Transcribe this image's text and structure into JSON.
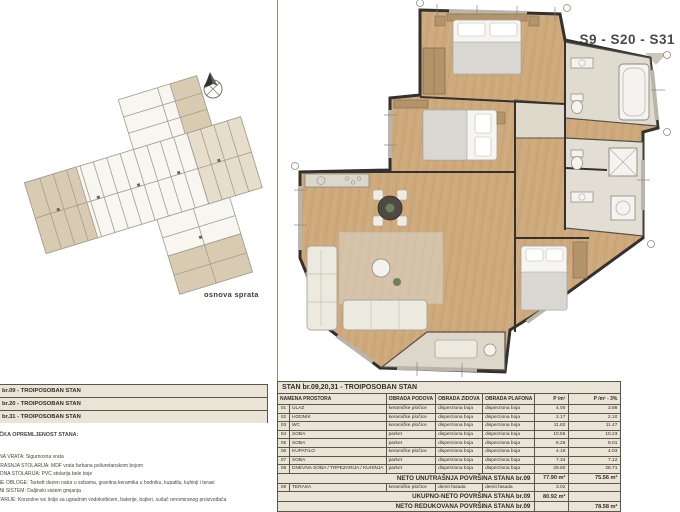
{
  "colors": {
    "paper": "#ffffff",
    "table_bg": "#eae4d6",
    "line_dark": "#5a564e",
    "wood_floor": "#cda97c",
    "tile_floor": "#e0dbcf",
    "site_beige": "#d8cbb2",
    "wall": "#33312d",
    "pointer_gray": "#ccc6b9",
    "accent_text": "#4a4a4a"
  },
  "left_panel": {
    "plan_caption": "osnova sprata",
    "apartment_list": [
      {
        "label": "AN br.09 - TROIPOSOBAN STAN"
      },
      {
        "label": "AN br.20 - TROIPOSOBAN STAN"
      },
      {
        "label": "AN br.31 - TROIPOSOBAN STAN"
      }
    ],
    "specs_heading": "HNIČKA OPREMLJENOST STANA:",
    "specs_lines": [
      "LAZNA VRATA: Sigurnosna vrata",
      "NUTRAŠNJA STOLARIJA: MDF vrata farbana poliuretanskom bojom",
      "ASADNA STOLARIJA: PVC stolarija bele boje",
      "ODNE OBLOGE: Tarkett dezen natur u sobama, granitna keramika u hodniku, kupatilu, kuhinji i terasi",
      "REJNI SISTEM: Daljinski sistem grejanja",
      "ANITARIJE: Konzolne wc šolje sa ugradnim vodokotlićem, baterije, bojleri, sušač renomiranog proizvođača"
    ]
  },
  "right_panel": {
    "units_label": "S9 - S20 - S31"
  },
  "table": {
    "title": "STAN br.09,20,31 - TROIPOSOBAN STAN",
    "headers": {
      "name": "NAMENA PROSTORA",
      "floor": "OBRADA PODOVA",
      "walls": "OBRADA ZIDOVA",
      "ceiling": "OBRADA PLAFONA",
      "area": "P /m²",
      "area_reduced": "P /m² - 3%"
    },
    "rows": [
      {
        "no": "01",
        "name": "ULAZ",
        "floor": "keramičke pločice",
        "walls": "disperziona boja",
        "ceiling": "disperziona boja",
        "area": "4.00",
        "area_reduced": "3.88"
      },
      {
        "no": "02",
        "name": "HODNIK",
        "floor": "keramičke pločice",
        "walls": "disperziona boja",
        "ceiling": "disperziona boja",
        "area": "2.17",
        "area_reduced": "2.10"
      },
      {
        "no": "03",
        "name": "WC",
        "floor": "keramičke pločice",
        "walls": "disperziona boja",
        "ceiling": "disperziona boja",
        "area": "11.82",
        "area_reduced": "11.47"
      },
      {
        "no": "04",
        "name": "SOBA",
        "floor": "parket",
        "walls": "disperziona boja",
        "ceiling": "disperziona boja",
        "area": "10.55",
        "area_reduced": "10.23"
      },
      {
        "no": "05",
        "name": "SOBA",
        "floor": "parket",
        "walls": "disperziona boja",
        "ceiling": "disperziona boja",
        "area": "8.26",
        "area_reduced": "8.01"
      },
      {
        "no": "06",
        "name": "KUPATILO",
        "floor": "keramičke pločice",
        "walls": "disperziona boja",
        "ceiling": "disperziona boja",
        "area": "4.16",
        "area_reduced": "4.03"
      },
      {
        "no": "07",
        "name": "SOBA",
        "floor": "parket",
        "walls": "disperziona boja",
        "ceiling": "disperziona boja",
        "area": "7.34",
        "area_reduced": "7.12"
      },
      {
        "no": "08",
        "name": "DNEVNA SOBA / TRPEZARIJA / KUHINJA",
        "floor": "parket",
        "walls": "disperziona boja",
        "ceiling": "disperziona boja",
        "area": "29.60",
        "area_reduced": "28.71"
      }
    ],
    "terasa_row": {
      "no": "09",
      "name": "TERASA",
      "floor": "keramičke pločice",
      "walls": "demit fasada",
      "ceiling": "demit fasada",
      "area": "3.02",
      "area_reduced": ""
    },
    "summary": {
      "neto_unutrasnja": {
        "label": "NETO UNUTRAŠNJA POVRŠINA STANA br.09",
        "area": "77.90 m²",
        "area_reduced": "75.56 m²"
      },
      "ukupno_neto": {
        "label": "UKUPNO-NETO POVRŠINA STANA br.09",
        "area": "80.92 m²",
        "area_reduced": ""
      },
      "neto_redukovana": {
        "label": "NETO REDUKOVANA POVRŠINA STANA br.09",
        "area": "",
        "area_reduced": "78.58 m²"
      }
    }
  }
}
